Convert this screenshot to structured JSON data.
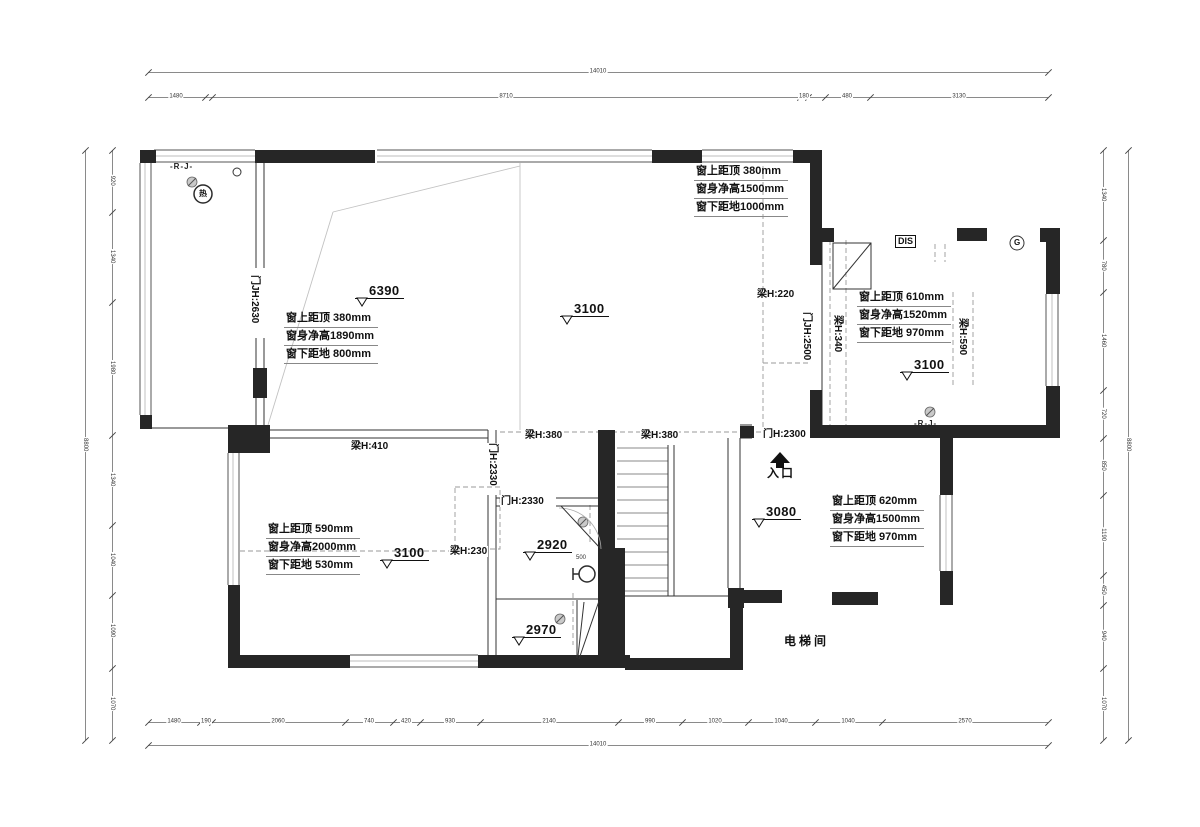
{
  "plan": {
    "window_blocks": {
      "balcony": {
        "l1": "窗上距顶 380mm",
        "l2": "窗身净高1890mm",
        "l3": "窗下距地 800mm"
      },
      "top": {
        "l1": "窗上距顶 380mm",
        "l2": "窗身净高1500mm",
        "l3": "窗下距地1000mm"
      },
      "east": {
        "l1": "窗上距顶 610mm",
        "l2": "窗身净高1520mm",
        "l3": "窗下距地 970mm"
      },
      "southwest": {
        "l1": "窗上距顶 590mm",
        "l2": "窗身净高2000mm",
        "l3": "窗下距地 530mm"
      },
      "entry": {
        "l1": "窗上距顶 620mm",
        "l2": "窗身净高1500mm",
        "l3": "窗下距地 970mm"
      }
    },
    "elevations": {
      "living_high": "6390",
      "living": "3100",
      "east_room": "3100",
      "southwest_room": "3100",
      "bath_upper": "2920",
      "bath_lower": "2970",
      "entry": "3080"
    },
    "beams": {
      "b220": "梁H:220",
      "b340": "梁H:340",
      "b590": "梁H:590",
      "b410": "梁H:410",
      "b380a": "梁H:380",
      "b380b": "梁H:380",
      "b230": "梁H:230"
    },
    "doors": {
      "d2630": "门JH:2630",
      "d2500": "门JH:2500",
      "d2300": "门H:2300",
      "d2330v": "门H:2330",
      "d2330h": "门H:2330"
    },
    "rooms": {
      "elevator": "电梯间",
      "entrance": "入口"
    },
    "misc": {
      "dis": "DIS",
      "g": "G",
      "rj_top": "-R-J-",
      "rj_east": "-R-J-",
      "heater": "热",
      "toilet_dim": "500"
    }
  },
  "dimensions": {
    "rows": [
      {
        "id": "top-outer",
        "dir": "h",
        "y": 72,
        "x1": 148,
        "x2": 1048,
        "ticks": [
          148,
          1048
        ],
        "labels": [
          {
            "pos": 598,
            "text": "14010"
          }
        ]
      },
      {
        "id": "top-inner",
        "dir": "h",
        "y": 97,
        "x1": 148,
        "x2": 1048,
        "ticks": [
          148,
          205,
          212,
          800,
          808,
          825,
          870,
          1048
        ],
        "labels": [
          {
            "pos": 176,
            "text": "1480"
          },
          {
            "pos": 506,
            "text": "8710"
          },
          {
            "pos": 804,
            "text": "180"
          },
          {
            "pos": 847,
            "text": "480"
          },
          {
            "pos": 959,
            "text": "3130"
          }
        ]
      },
      {
        "id": "bottom-inner",
        "dir": "h",
        "y": 722,
        "x1": 148,
        "x2": 1048,
        "ticks": [
          148,
          200,
          212,
          345,
          393,
          420,
          480,
          618,
          682,
          748,
          815,
          882,
          1048
        ],
        "labels": [
          {
            "pos": 174,
            "text": "1480"
          },
          {
            "pos": 206,
            "text": "190"
          },
          {
            "pos": 278,
            "text": "2060"
          },
          {
            "pos": 369,
            "text": "740"
          },
          {
            "pos": 406,
            "text": "420"
          },
          {
            "pos": 450,
            "text": "930"
          },
          {
            "pos": 549,
            "text": "2140"
          },
          {
            "pos": 650,
            "text": "990"
          },
          {
            "pos": 715,
            "text": "1020"
          },
          {
            "pos": 781,
            "text": "1040"
          },
          {
            "pos": 848,
            "text": "1040"
          },
          {
            "pos": 965,
            "text": "2570"
          }
        ]
      },
      {
        "id": "bottom-outer",
        "dir": "h",
        "y": 745,
        "x1": 148,
        "x2": 1048,
        "ticks": [
          148,
          1048
        ],
        "labels": [
          {
            "pos": 598,
            "text": "14010"
          }
        ]
      },
      {
        "id": "left-outer",
        "dir": "v",
        "x": 85,
        "y1": 150,
        "y2": 740,
        "ticks": [
          150,
          740
        ],
        "labels": [
          {
            "pos": 445,
            "text": "8800"
          }
        ]
      },
      {
        "id": "left-inner",
        "dir": "v",
        "x": 112,
        "y1": 150,
        "y2": 740,
        "ticks": [
          150,
          212,
          302,
          435,
          525,
          595,
          668,
          740
        ],
        "labels": [
          {
            "pos": 181,
            "text": "920"
          },
          {
            "pos": 257,
            "text": "1340"
          },
          {
            "pos": 368,
            "text": "1980"
          },
          {
            "pos": 480,
            "text": "1340"
          },
          {
            "pos": 560,
            "text": "1040"
          },
          {
            "pos": 631,
            "text": "1090"
          },
          {
            "pos": 704,
            "text": "1070"
          }
        ]
      },
      {
        "id": "right-inner",
        "dir": "v",
        "x": 1103,
        "y1": 150,
        "y2": 740,
        "ticks": [
          150,
          240,
          292,
          390,
          438,
          495,
          575,
          605,
          668,
          740
        ],
        "labels": [
          {
            "pos": 195,
            "text": "1340"
          },
          {
            "pos": 266,
            "text": "780"
          },
          {
            "pos": 341,
            "text": "1460"
          },
          {
            "pos": 414,
            "text": "720"
          },
          {
            "pos": 466,
            "text": "850"
          },
          {
            "pos": 535,
            "text": "1190"
          },
          {
            "pos": 590,
            "text": "450"
          },
          {
            "pos": 636,
            "text": "940"
          },
          {
            "pos": 704,
            "text": "1070"
          }
        ]
      },
      {
        "id": "right-outer",
        "dir": "v",
        "x": 1128,
        "y1": 150,
        "y2": 740,
        "ticks": [
          150,
          740
        ],
        "labels": [
          {
            "pos": 445,
            "text": "8800"
          }
        ]
      }
    ]
  }
}
